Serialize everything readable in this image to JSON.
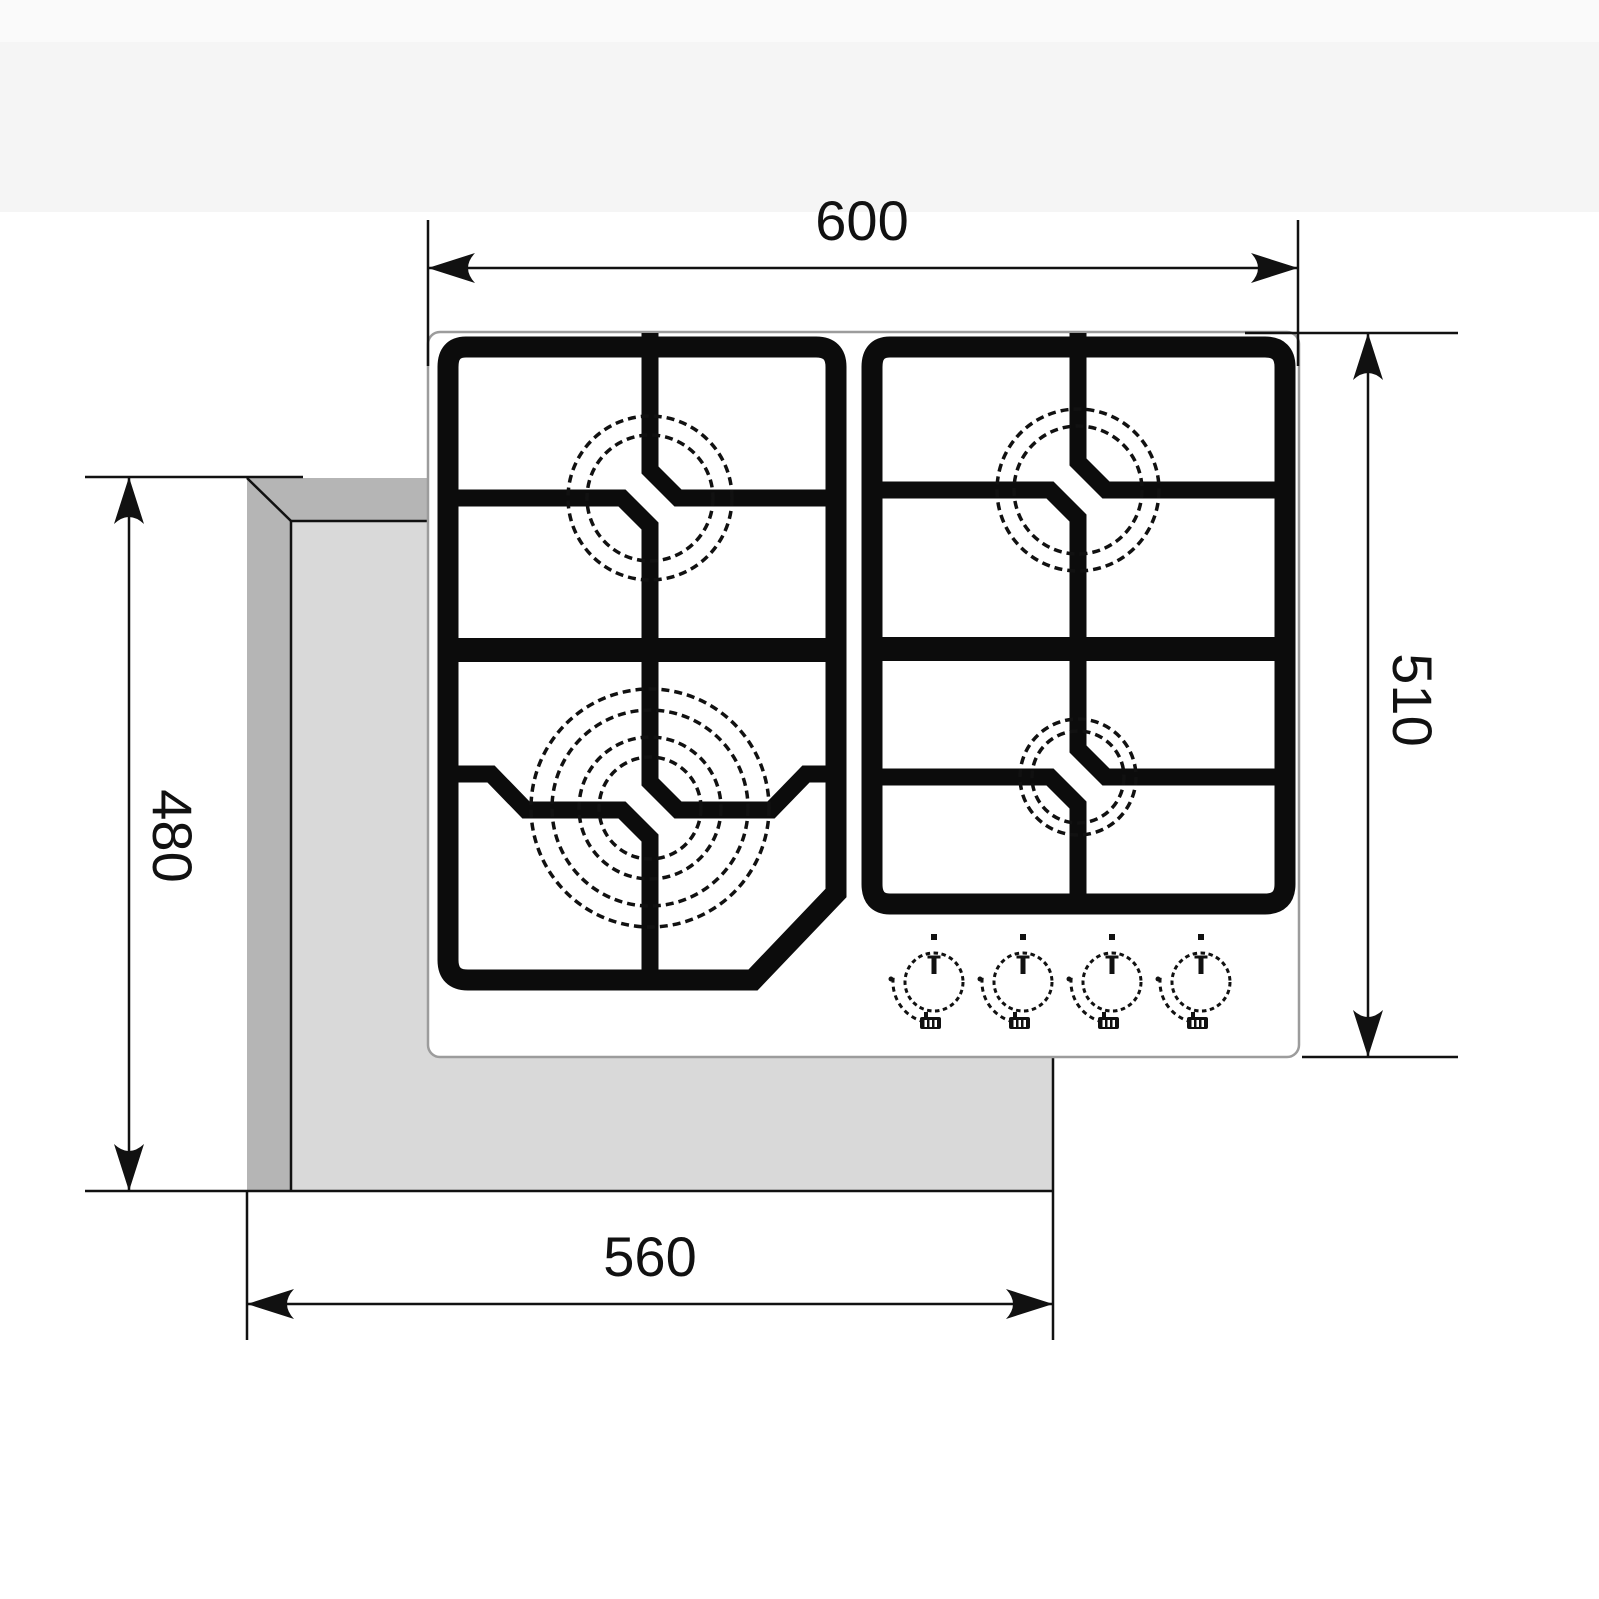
{
  "diagram": {
    "title": "gas-hob-installation-dimensions",
    "dim_top_width": "600",
    "dim_right_height": "510",
    "dim_left_height": "480",
    "dim_bottom_width": "560"
  },
  "colors": {
    "line": "#111111",
    "grate": "#0c0c0c",
    "hob_fill": "#ffffff",
    "hob_outline": "#9c9c9c",
    "countertop_surface": "#d9d9d9",
    "countertop_bevel": "#b5b5b5",
    "background_band_top": "#fafafa",
    "background_band_second": "#f5f5f5"
  },
  "icons": {
    "arrowheads": "filled-cad-arrow",
    "knob_pointer": "t-mark",
    "knob_flame_icon": "pan-on-flame"
  }
}
